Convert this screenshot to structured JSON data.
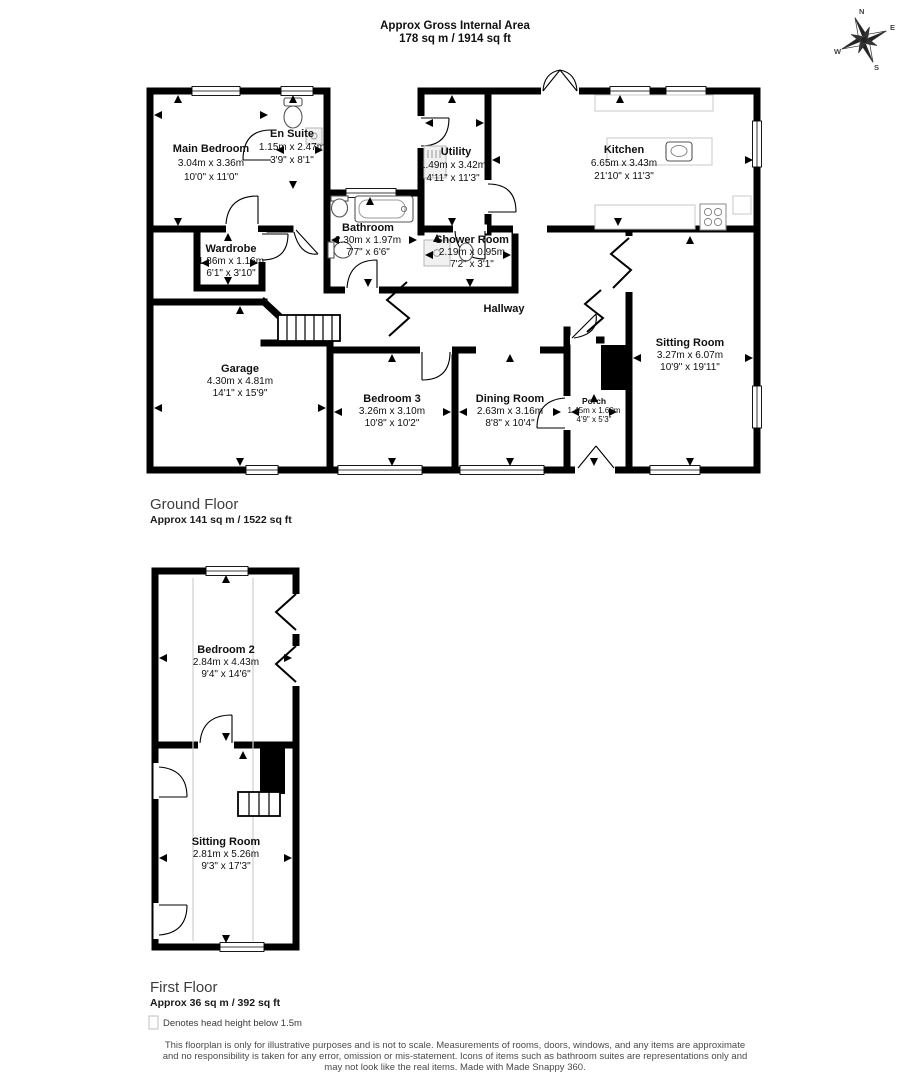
{
  "header": {
    "line1": "Approx Gross Internal Area",
    "line2": "178 sq m / 1914 sq ft"
  },
  "compass": {
    "north": "N",
    "east": "E",
    "south": "S",
    "west": "W"
  },
  "ground_floor": {
    "title": "Ground Floor",
    "area": "Approx 141 sq m / 1522 sq ft",
    "rooms": {
      "main_bedroom": {
        "name": "Main Bedroom",
        "metric": "3.04m x 3.36m",
        "imperial": "10'0\" x 11'0\""
      },
      "en_suite": {
        "name": "En Suite",
        "metric": "1.15m x 2.47m",
        "imperial": "3'9\" x 8'1\""
      },
      "utility": {
        "name": "Utility",
        "metric": "1.49m x 3.42m",
        "imperial": "4'11\" x 11'3\""
      },
      "kitchen": {
        "name": "Kitchen",
        "metric": "6.65m x 3.43m",
        "imperial": "21'10\" x 11'3\""
      },
      "wardrobe": {
        "name": "Wardrobe",
        "metric": "1.86m x 1.16m",
        "imperial": "6'1\" x 3'10\""
      },
      "bathroom": {
        "name": "Bathroom",
        "metric": "2.30m x 1.97m",
        "imperial": "7'7\" x 6'6\""
      },
      "shower_room": {
        "name": "Shower Room",
        "metric": "2.19m x 0.95m",
        "imperial": "7'2\" x 3'1\""
      },
      "hallway": {
        "name": "Hallway"
      },
      "sitting_room": {
        "name": "Sitting Room",
        "metric": "3.27m x 6.07m",
        "imperial": "10'9\" x 19'11\""
      },
      "garage": {
        "name": "Garage",
        "metric": "4.30m x 4.81m",
        "imperial": "14'1\" x 15'9\""
      },
      "bedroom_3": {
        "name": "Bedroom 3",
        "metric": "3.26m x 3.10m",
        "imperial": "10'8\" x 10'2\""
      },
      "dining_room": {
        "name": "Dining Room",
        "metric": "2.63m x 3.16m",
        "imperial": "8'8\" x 10'4\""
      },
      "porch": {
        "name": "Porch",
        "metric": "1.45m x 1.60m",
        "imperial": "4'9\" x 5'3\""
      }
    }
  },
  "first_floor": {
    "title": "First Floor",
    "area": "Approx 36 sq m / 392 sq ft",
    "rooms": {
      "bedroom_2": {
        "name": "Bedroom 2",
        "metric": "2.84m x 4.43m",
        "imperial": "9'4\" x 14'6\""
      },
      "sitting_room": {
        "name": "Sitting Room",
        "metric": "2.81m x 5.26m",
        "imperial": "9'3\" x 17'3\""
      }
    }
  },
  "legend": {
    "text": "Denotes head height below 1.5m"
  },
  "disclaimer": {
    "line1": "This floorplan is only for illustrative purposes and is not to scale. Measurements of rooms, doors, windows, and any items are approximate",
    "line2": "and no responsibility is taken for any error, omission or mis-statement. Icons of items such as bathroom suites are representations only and",
    "line3": "may not look like the real items. Made with Made Snappy 360."
  }
}
